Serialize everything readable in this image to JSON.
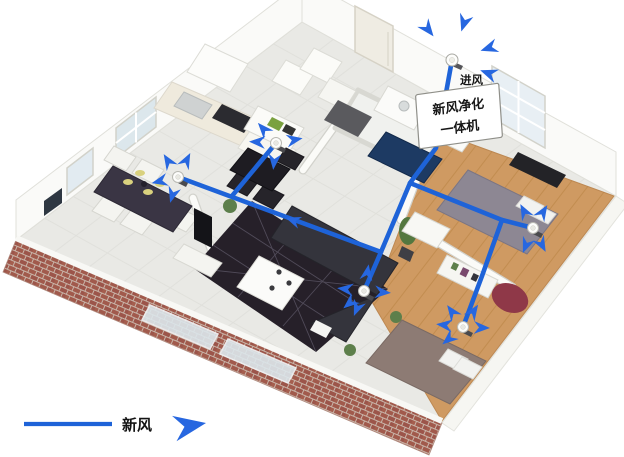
{
  "labels": {
    "intake": "进风",
    "unit_line1": "新风净化",
    "unit_line2": "一体机",
    "legend_fresh_air": "新风"
  },
  "colors": {
    "duct_blue": "#1e63d8",
    "arrow_blue": "#2767e0",
    "brick_red": "#a15a4c",
    "brick_mortar": "#c9b5a9",
    "wood_floor": "#cf9a62",
    "tile_floor": "#e9e9e5",
    "wall_white": "#fafaf8",
    "rug_dark": "#262029",
    "sofa_dark": "#34343c",
    "machine_navy": "#1d3a63",
    "bed1_gray": "#8d8793",
    "bed2_taupe": "#8d7b74",
    "chair_red": "#8f3848",
    "plant_green": "#5d7f4b",
    "glass_blue": "#dce7ec",
    "label_text": "#161616"
  },
  "icons": {
    "diffuser": "ceiling-air-diffuser-icon",
    "flow_arrow": "airflow-arrow-icon",
    "intake_vent": "roof-air-intake-icon"
  }
}
